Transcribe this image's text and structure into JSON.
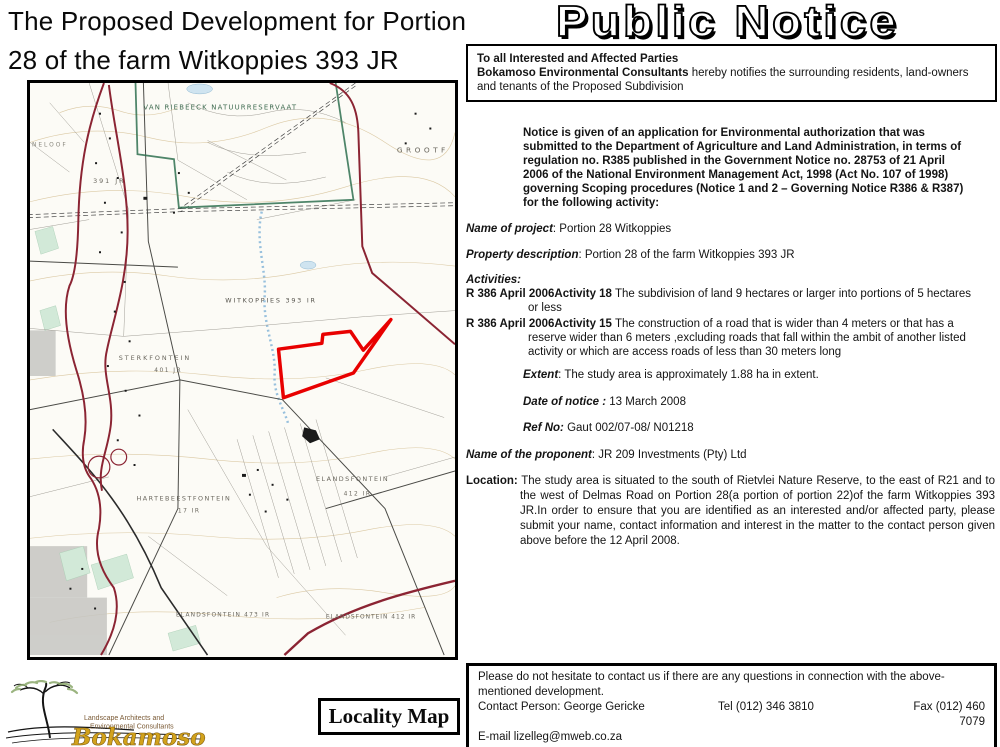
{
  "page": {
    "title_line1": "The Proposed Development for Portion",
    "title_line2": "28 of the farm Witkoppies 393 JR"
  },
  "headline": {
    "text": "Public Notice"
  },
  "intro_box": {
    "line1": "To all Interested and Affected Parties",
    "consultant": "Bokamoso Environmental Consultants",
    "line2_rest": " hereby notifies the surrounding residents, land-owners and tenants of the Proposed Subdivision"
  },
  "notice": {
    "paragraph": "Notice is given of an application for Environmental authorization that was submitted to the Department of Agriculture and Land Administration, in terms of regulation no. R385 published in the Government Notice no. 28753 of 21 April 2006 of the National Environment Management Act, 1998 (Act No. 107 of 1998) governing Scoping procedures (Notice 1 and 2 – Governing Notice R386 & R387) for the following activity:",
    "project": {
      "label": "Name of project",
      "value": ": Portion 28 Witkoppies"
    },
    "property": {
      "label": "Property description",
      "value": ": Portion 28 of the farm Witkoppies 393 JR"
    },
    "activities_label": "Activities:",
    "activity1": {
      "label": "R 386 April 2006Activity 18",
      "value": " The subdivision of land 9 hectares or larger into portions of 5 hectares or less"
    },
    "activity2": {
      "label": "R 386 April 2006Activity 15",
      "value": " The construction of a road that is wider than 4 meters or that has a reserve wider than 6 meters ,excluding roads that fall within the ambit of another listed activity or which are access roads of less than 30 meters long"
    },
    "extent": {
      "label": "Extent",
      "value": ": The study area is approximately 1.88  ha in extent."
    },
    "date_of_notice": {
      "label": "Date of notice :",
      "value": " 13 March 2008"
    },
    "ref_no": {
      "label": "Ref No:",
      "value": " Gaut 002/07-08/ N01218"
    },
    "proponent": {
      "label": "Name of the proponent",
      "value": ": JR 209 Investments (Pty) Ltd"
    },
    "location": {
      "label": "Location:",
      "value": " The study area is situated to the south of Rietvlei Nature Reserve, to the east of R21 and to the west of Delmas Road on Portion 28(a portion of portion 22)of the farm Witkoppies 393 JR.In order to ensure that you are identified as an interested and/or affected party, please submit your name, contact information and interest in the matter to the contact person given above before the 12 April 2008."
    }
  },
  "contact_box": {
    "line1": "Please do not hesitate to contact us if there are any questions in connection  with the above-mentioned development.",
    "person": "Contact Person: George Gericke",
    "tel": "Tel (012) 346 3810",
    "fax": "Fax (012) 460 7079",
    "email": "E-mail lizelleg@mweb.co.za"
  },
  "locality": {
    "label": "Locality Map"
  },
  "logo": {
    "tagline1": "Landscape Architects and",
    "tagline2": "Environmental Consultants",
    "name": "Bokamoso"
  },
  "map": {
    "labels": {
      "reserve": "VAN RIEBEECK NATUURRESERVAAT",
      "grootfontein": "GROOTF",
      "kloof_partial": "NELOOF",
      "farm_391": "391 JR",
      "witkoppies": "WITKOPPIES 393 IR",
      "sterkfontein": "STERKFONTEIN",
      "sterkfontein_no": "401 JR",
      "hartebeestfontein": "HARTEBEESTFONTEIN",
      "hartebeestfontein_no": "17 IR",
      "elandsfontein_e": "ELANDSFONTEIN",
      "elandsfontein_e_no": "412 IR",
      "elandsfontein_s1": "ELANDSFONTEIN 473 IR",
      "elandsfontein_s2": "ELANDSFONTEIN 412 IR"
    },
    "colors": {
      "study_area_outline": "#e80000",
      "main_roads": "#8b2433",
      "reserve_boundary": "#2f7050",
      "logo_gold": "#d2a21c"
    }
  }
}
